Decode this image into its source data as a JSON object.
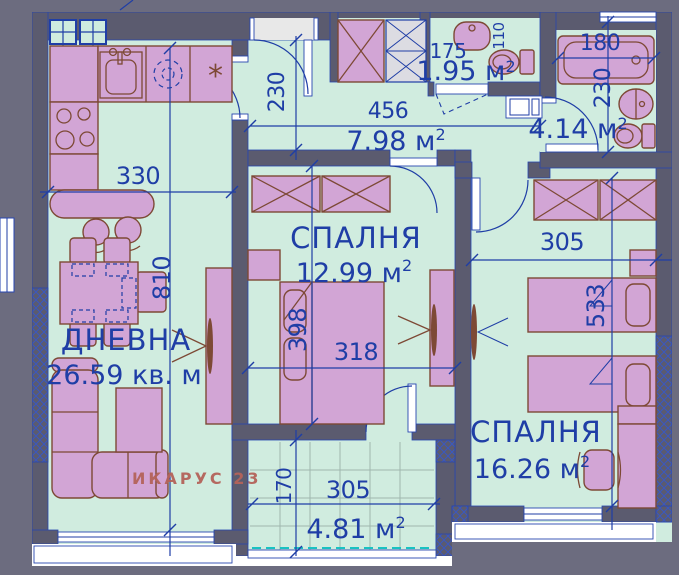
{
  "watermark": {
    "text": "ИКАРУС 23"
  },
  "rooms": {
    "living": {
      "label": "ДНЕВНА",
      "area": "26.59 кв. м"
    },
    "bedroom1": {
      "label": "СПАЛНЯ",
      "area": "12.99 м",
      "area_sup": "2"
    },
    "bedroom2": {
      "label": "СПАЛНЯ",
      "area": "16.26 м",
      "area_sup": "2"
    },
    "corridor": {
      "area": "7.98 м",
      "area_sup": "2"
    },
    "wc": {
      "area": "1.95 м",
      "area_sup": "2"
    },
    "bathroom": {
      "area": "4.14 м",
      "area_sup": "2"
    },
    "terrace": {
      "area": "4.81 м",
      "area_sup": "2"
    }
  },
  "dims": {
    "living_width": "330",
    "living_depth": "810",
    "corridor_depth": "230",
    "corridor_length": "456",
    "wc_width": "175",
    "wc_depth": "110",
    "bath_width": "180",
    "bath_depth": "230",
    "bedroom1_width": "318",
    "bedroom1_depth": "398",
    "bedroom2_width": "305",
    "bedroom2_depth": "533",
    "terrace_width": "305",
    "terrace_depth": "170"
  },
  "kitchen": {
    "star_symbol": "*"
  },
  "colors": {
    "background": "#6c6c7f",
    "wall": "#5b5b6f",
    "floor": "#d0ecdf",
    "furniture": "#d2a5d5",
    "furniture_outline": "#7d4935",
    "drawing_blue": "#1f3ea6",
    "watermark": "#b4635a",
    "railing_cyan": "#19c2c2"
  }
}
